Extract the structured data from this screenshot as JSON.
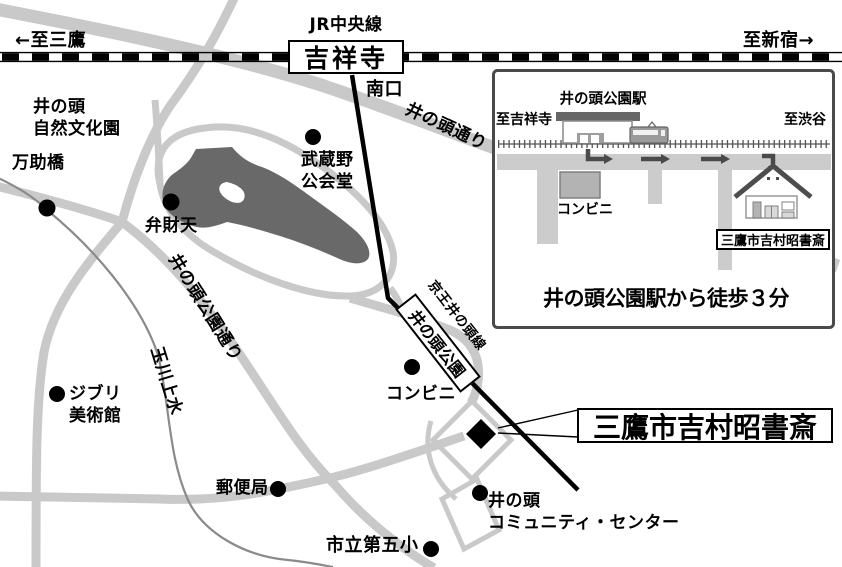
{
  "main_map": {
    "jr_line_label": "JR中央線",
    "jr_station": "吉祥寺",
    "to_mitaka": "←至三鷹",
    "to_shinjuku": "至新宿→",
    "south_exit": "南口",
    "inokashira_dori": "井の頭通り",
    "keio_line_label": "京王井の頭線",
    "keio_station": "井の頭公園",
    "koen_dori": "井の頭公園通り",
    "tamagawa_josui": "玉川上水",
    "landmarks": {
      "nature_park_line1": "井の頭",
      "nature_park_line2": "自然文化園",
      "mansuke_bridge": "万助橋",
      "musashino_hall_line1": "武蔵野",
      "musashino_hall_line2": "公会堂",
      "benzaiten": "弁財天",
      "ghibli_line1": "ジブリ",
      "ghibli_line2": "美術館",
      "post_office": "郵便局",
      "convenience_store": "コンビニ",
      "community_line1": "井の頭",
      "community_line2": "コミュニティ・センター",
      "elementary_school": "市立第五小"
    },
    "destination_label": "三鷹市吉村昭書斎"
  },
  "inset": {
    "station_label": "井の頭公園駅",
    "to_kichijoji": "至吉祥寺",
    "to_shibuya": "至渋谷",
    "convenience_store": "コンビニ",
    "destination_label": "三鷹市吉村昭書斎",
    "walk_note": "井の頭公園駅から徒歩３分"
  },
  "colors": {
    "road_gray": "#c9c9c9",
    "pond_gray": "#696969",
    "canal_gray": "#8a8a8a",
    "rail_black": "#000000",
    "inset_border": "#4a4a4a",
    "icon_gray": "#666666"
  }
}
